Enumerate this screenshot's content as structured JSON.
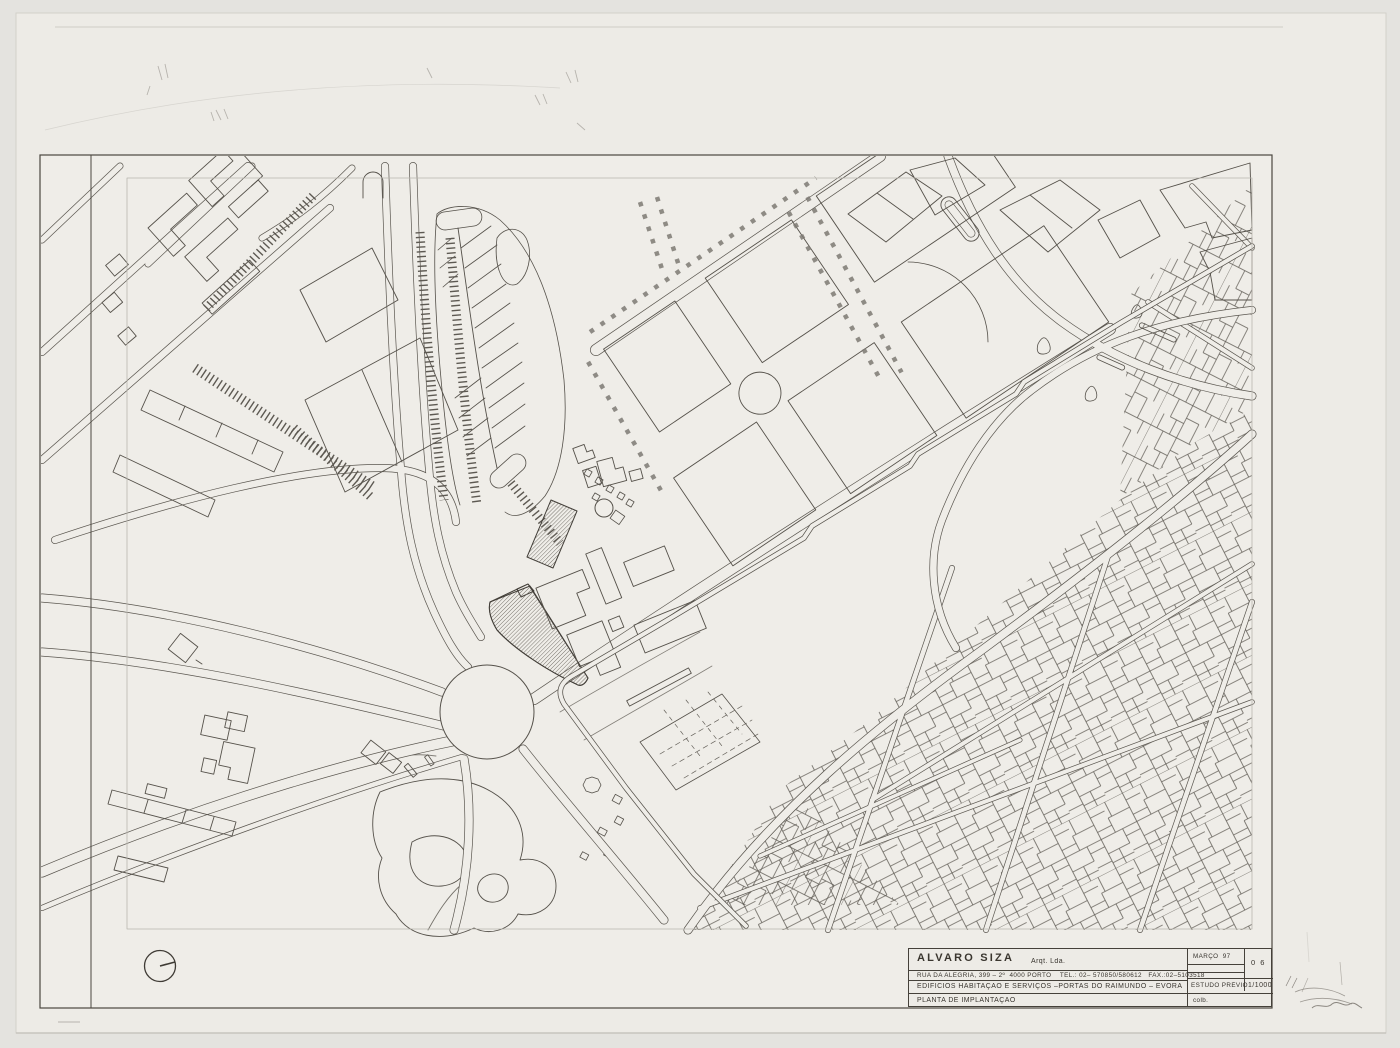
{
  "sheet": {
    "kind": "architectural site plan drawing",
    "title_block": {
      "architect_name": "ALVARO SIZA",
      "architect_suffix": "Arqt. Lda.",
      "address_line": "RUA DA ALEGRIA, 399 – 2º  4000 PORTO    TEL.: 02– 570850/580612   FAX.:02–5103518",
      "project_line": "EDIFICIOS HABITAÇÃO E SERVIÇOS –PORTAS DO RAIMUNDO – ÉVORA",
      "drawing_title": "PLANTA DE IMPLANTAÇÃO",
      "date": "MARÇO  97",
      "sheet_number": "0 6",
      "phase": "ESTUDO PRÉVIO",
      "scale": "1/1000",
      "collaborator_label": "colb."
    },
    "colors": {
      "paper": "#edebe6",
      "background": "#e4e3df",
      "ink": "#55514a",
      "hatch": "#6e6a63"
    }
  }
}
